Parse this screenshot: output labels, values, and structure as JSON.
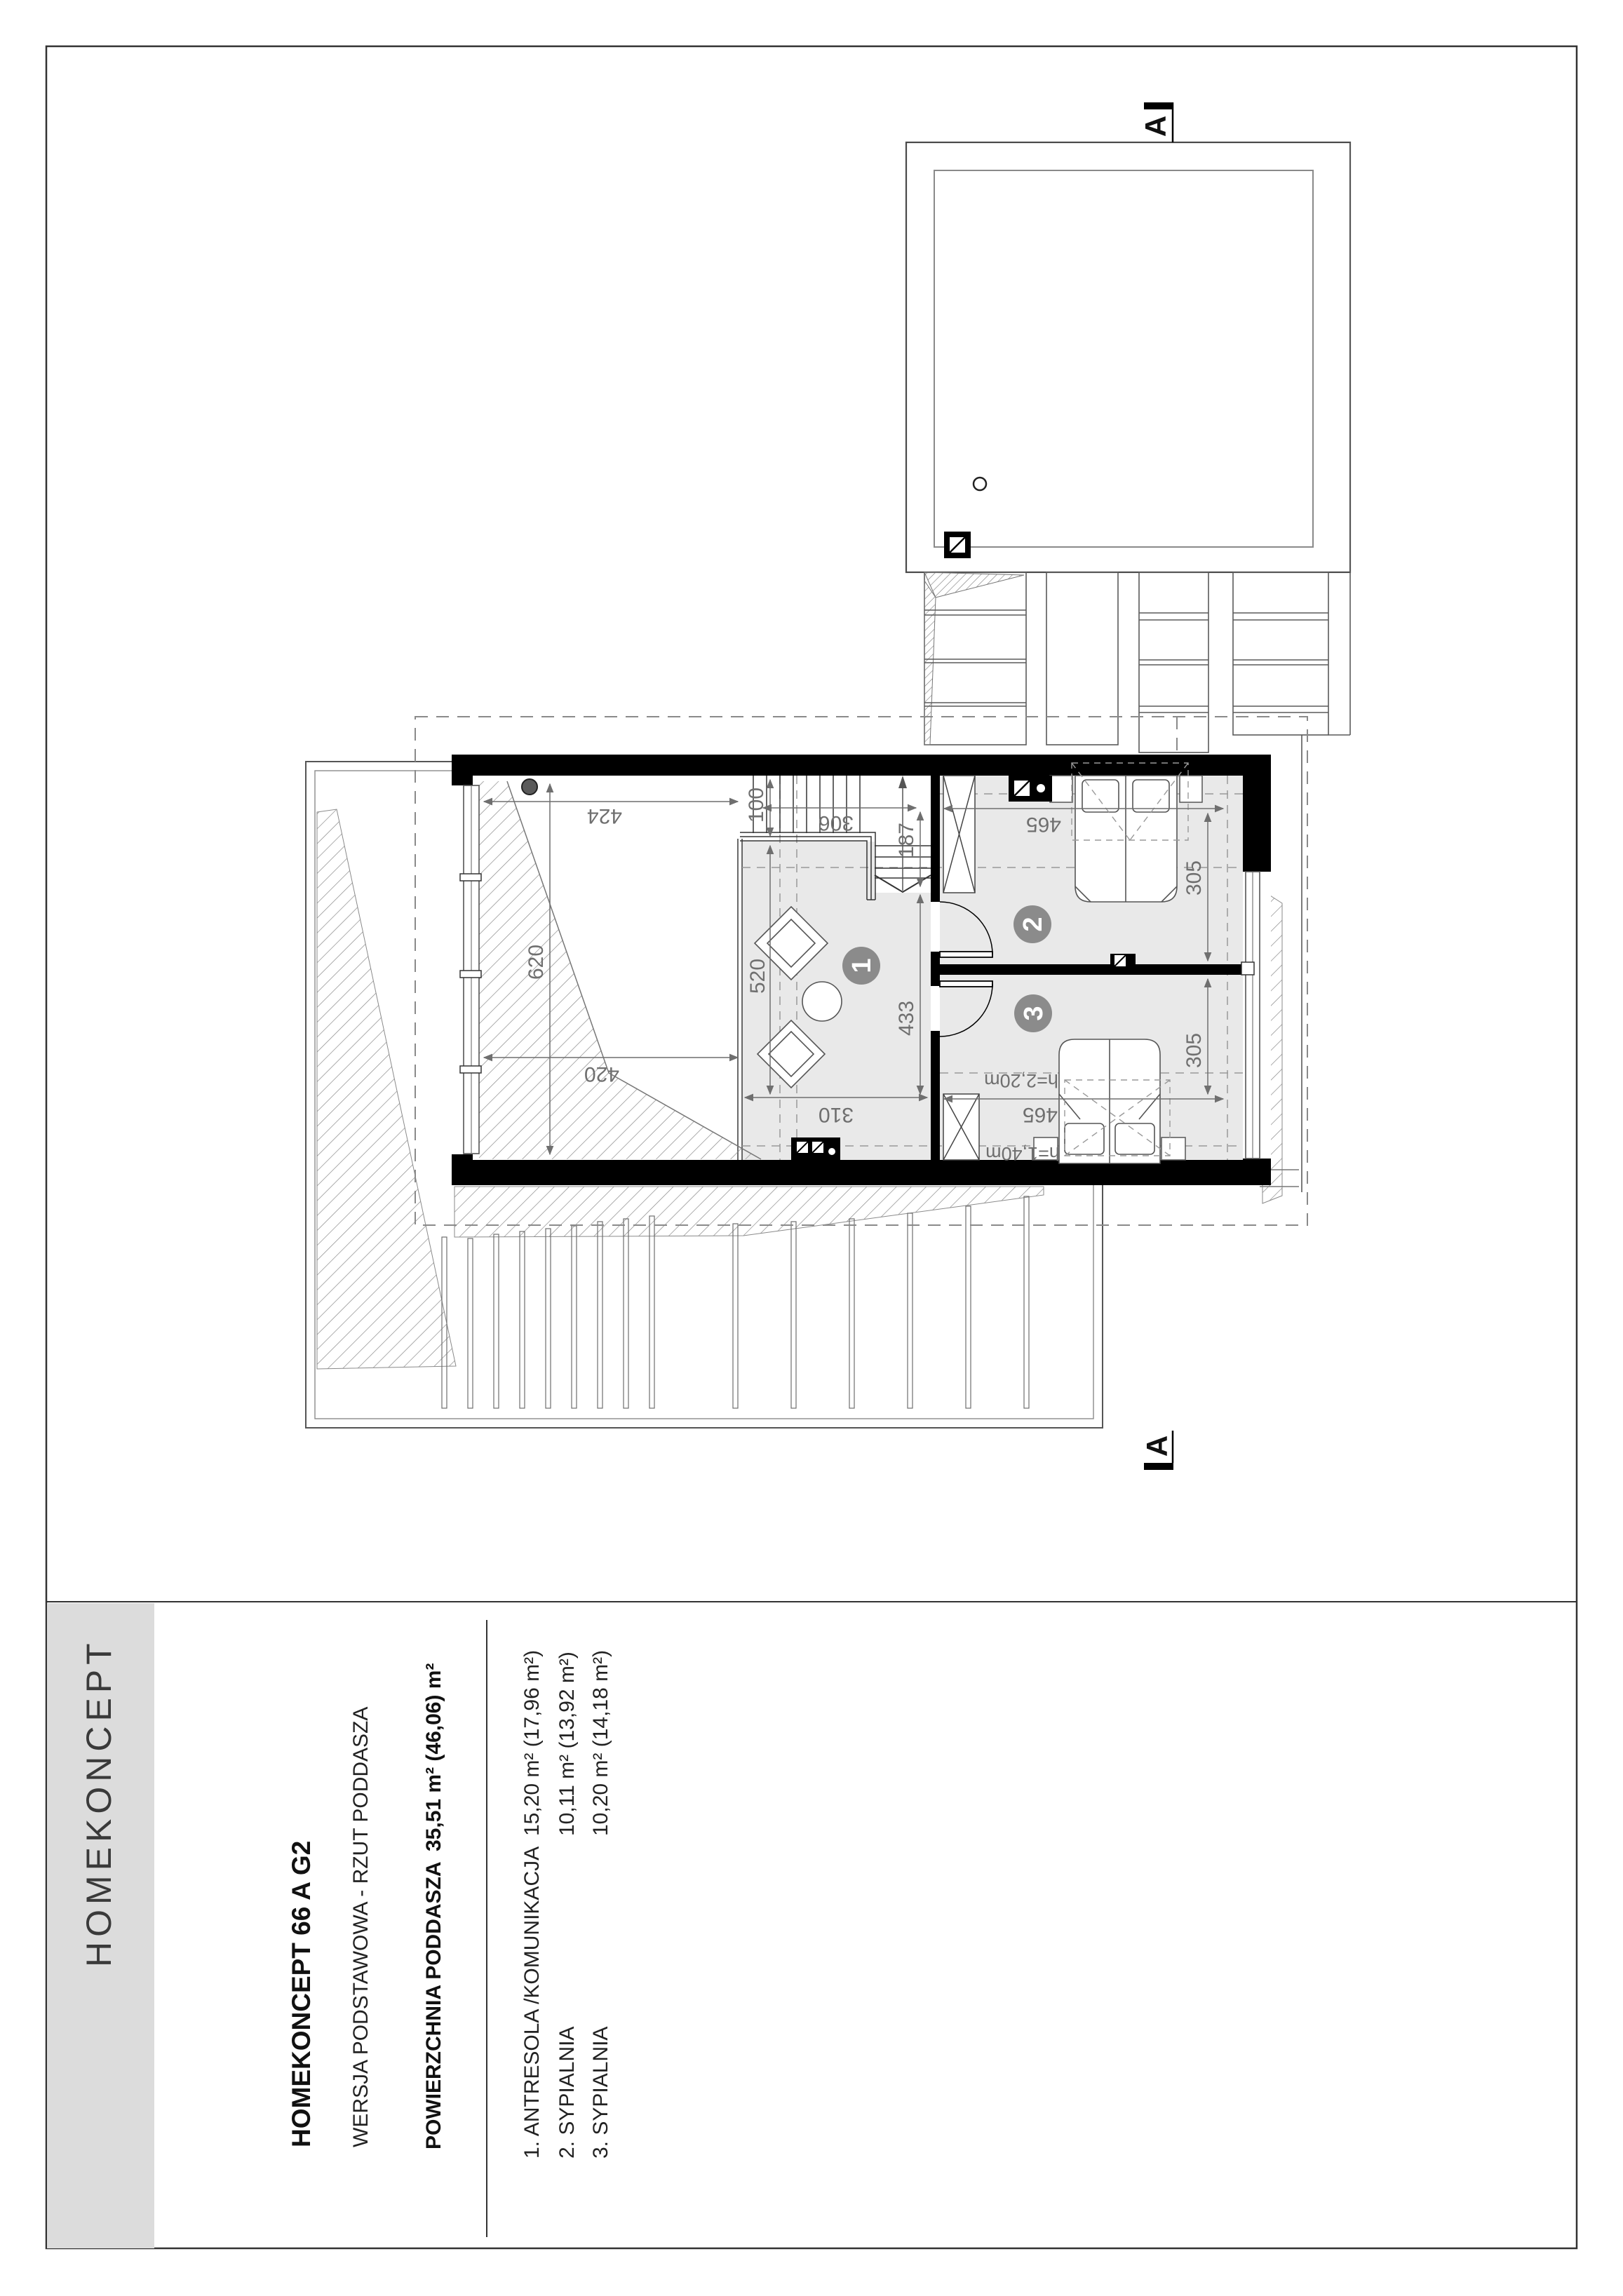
{
  "sheet": {
    "logo": "HOMEKONCEPT",
    "title": "HOMEKONCEPT 66 A G2",
    "version_line": "WERSJA  PODSTAWOWA      -      RZUT PODDASZA",
    "area_label": "POWIERZCHNIA PODDASZA",
    "area_value": "35,51 m² (46,06) m²",
    "rooms": [
      {
        "name": "1.  ANTRESOLA /KOMUNIKACJA",
        "area": "15,20 m² (17,96 m²)"
      },
      {
        "name": "2.  SYPIALNIA",
        "area": "10,11 m² (13,92 m²)"
      },
      {
        "name": "3.  SYPIALNIA",
        "area": "10,20 m² (14,18 m²)"
      }
    ]
  },
  "plan": {
    "section_marker": "A",
    "badges": [
      "1",
      "2",
      "3"
    ],
    "dimensions": {
      "top_width": "424",
      "bottom_width": "420",
      "void_height": "620",
      "hall_width": "310",
      "hall_height": "433",
      "floor_width": "520",
      "stair_width": "306",
      "stair_depth": "187",
      "landing": "100",
      "room2_width": "465",
      "room2_height": "305",
      "room3_width": "465",
      "room3_height": "305",
      "h_220": "h=2,20m",
      "h_140": "h=1,40m"
    },
    "colors": {
      "wall": "#000000",
      "floor": "#e9e9e9",
      "dim": "#6f6f6f",
      "badge": "#8b8b8b",
      "panel": "#dcdcdc"
    }
  }
}
